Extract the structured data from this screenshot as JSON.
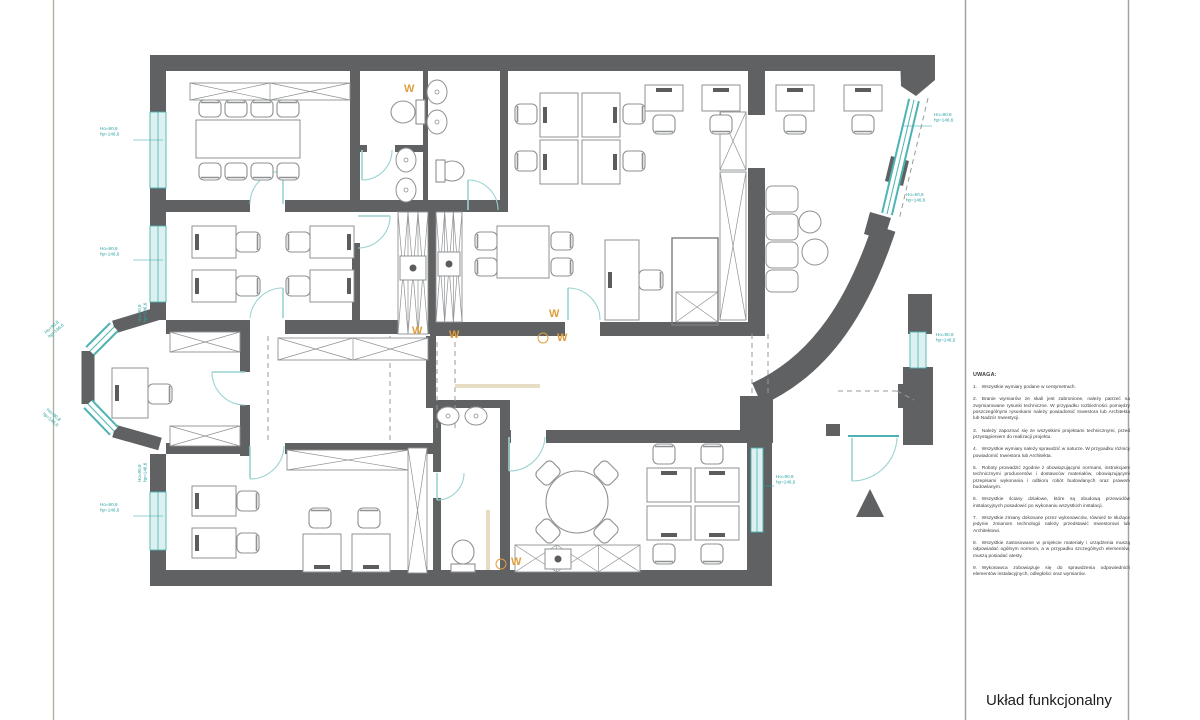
{
  "palette": {
    "wall": "#5f6163",
    "furniture": "#8f9193",
    "furniture_dark": "#5a5c5e",
    "glass_fill": "#ddf1f1",
    "glass_stroke": "#4fb3b3",
    "door": "#9ad2d2",
    "dim_text": "#2fa3a3",
    "orange": "#de9e3e",
    "dash": "#9a9a9a",
    "frame_left": "#a9b098",
    "frame_right": "#a2a2a2",
    "beige": "#e7dcc4"
  },
  "title_block": {
    "title": "Układ funkcjonalny"
  },
  "notes": {
    "heading": "UWAGA:",
    "items": [
      {
        "num": "1.",
        "text": "Wszystkie wymiary podane w centymetrach."
      },
      {
        "num": "2.",
        "text": "Branie wymiarów ze skali jest zabronione, należy patrzeć na zwymiarowane rysunki techniczne. W przypadku rozbieżności pomiędzy poszczególnymi rysunkami należy powiadomić Inwestora lub Architekta lub Nadzór Inwestycji."
      },
      {
        "num": "3.",
        "text": "Należy zapoznać się ze wszystkimi projektami technicznymi, przed przystąpieniem do realizacji projektu."
      },
      {
        "num": "4.",
        "text": "Wszystkie wymiary należy sprawdzić w naturze. W przypadku różnicy powiadomić Inwestora lub Architekta."
      },
      {
        "num": "5.",
        "text": "Roboty prowadzić zgodnie z obowiązującymi normami, instrukcjami technicznymi producentów i dostawców materiałów, obowiązującymi przepisami wykonania i odbioru robót budowlanych oraz prawem budowlanym."
      },
      {
        "num": "6.",
        "text": "Wszystkie ściany działowe, które są obudową przewodów instalacyjnych posadowić po wykonaniu wszystkich instalacji."
      },
      {
        "num": "7.",
        "text": "Wszystkie zmiany dokonane przez wykonawców, również te służące jedynie zmianom technologii należy przedstawić Inwestorowi lub Architektowi."
      },
      {
        "num": "8.",
        "text": "Wszystkie zastosowane w projekcie materiały i urządzenia muszą odpowiadać ogólnym normom, a w przypadku szczególnych elementów, muszą posiadać atesty."
      },
      {
        "num": "9.",
        "text": "Wykonawca zobowiązuje się do sprawdzenia odpowiednich elementów instalacyjnych, odległości oraz wymiarów."
      }
    ]
  },
  "annotations": {
    "w_label": "W",
    "w_marks": [
      {
        "x": 404,
        "y": 92
      },
      {
        "x": 412,
        "y": 334
      },
      {
        "x": 449,
        "y": 338
      },
      {
        "x": 549,
        "y": 317
      },
      {
        "x": 557,
        "y": 341
      },
      {
        "x": 511,
        "y": 565
      }
    ],
    "w_circles": [
      {
        "x": 543,
        "y": 338,
        "r": 5
      },
      {
        "x": 501,
        "y": 564,
        "r": 5
      }
    ],
    "dim_line1": "Ho=90,8",
    "dim_line2": "hp=146,6",
    "dimension_labels": [
      {
        "x": 100,
        "y": 130,
        "rot": 0,
        "lx1": 133,
        "ly1": 140,
        "lx2": 163,
        "ly2": 140
      },
      {
        "x": 100,
        "y": 250,
        "rot": 0,
        "lx1": 133,
        "ly1": 260,
        "lx2": 163,
        "ly2": 260
      },
      {
        "x": 100,
        "y": 506,
        "rot": 0,
        "lx1": 133,
        "ly1": 516,
        "lx2": 163,
        "ly2": 516
      },
      {
        "x": 141,
        "y": 322,
        "rot": -90,
        "lx1": 0,
        "ly1": 0,
        "lx2": 0,
        "ly2": 0
      },
      {
        "x": 141,
        "y": 482,
        "rot": -90,
        "lx1": 0,
        "ly1": 0,
        "lx2": 0,
        "ly2": 0
      },
      {
        "x": 46,
        "y": 334,
        "rot": -41,
        "lx1": 0,
        "ly1": 0,
        "lx2": 0,
        "ly2": 0
      },
      {
        "x": 46,
        "y": 410,
        "rot": 41,
        "lx1": 0,
        "ly1": 0,
        "lx2": 0,
        "ly2": 0
      },
      {
        "x": 934,
        "y": 116,
        "rot": 0,
        "lx1": 903,
        "ly1": 126,
        "lx2": 932,
        "ly2": 126
      },
      {
        "x": 906,
        "y": 196,
        "rot": 0,
        "lx1": 0,
        "ly1": 0,
        "lx2": 0,
        "ly2": 0
      },
      {
        "x": 936,
        "y": 336,
        "rot": 0,
        "lx1": 0,
        "ly1": 0,
        "lx2": 0,
        "ly2": 0
      },
      {
        "x": 776,
        "y": 478,
        "rot": 0,
        "lx1": 764,
        "ly1": 486,
        "lx2": 774,
        "ly2": 486
      }
    ]
  }
}
